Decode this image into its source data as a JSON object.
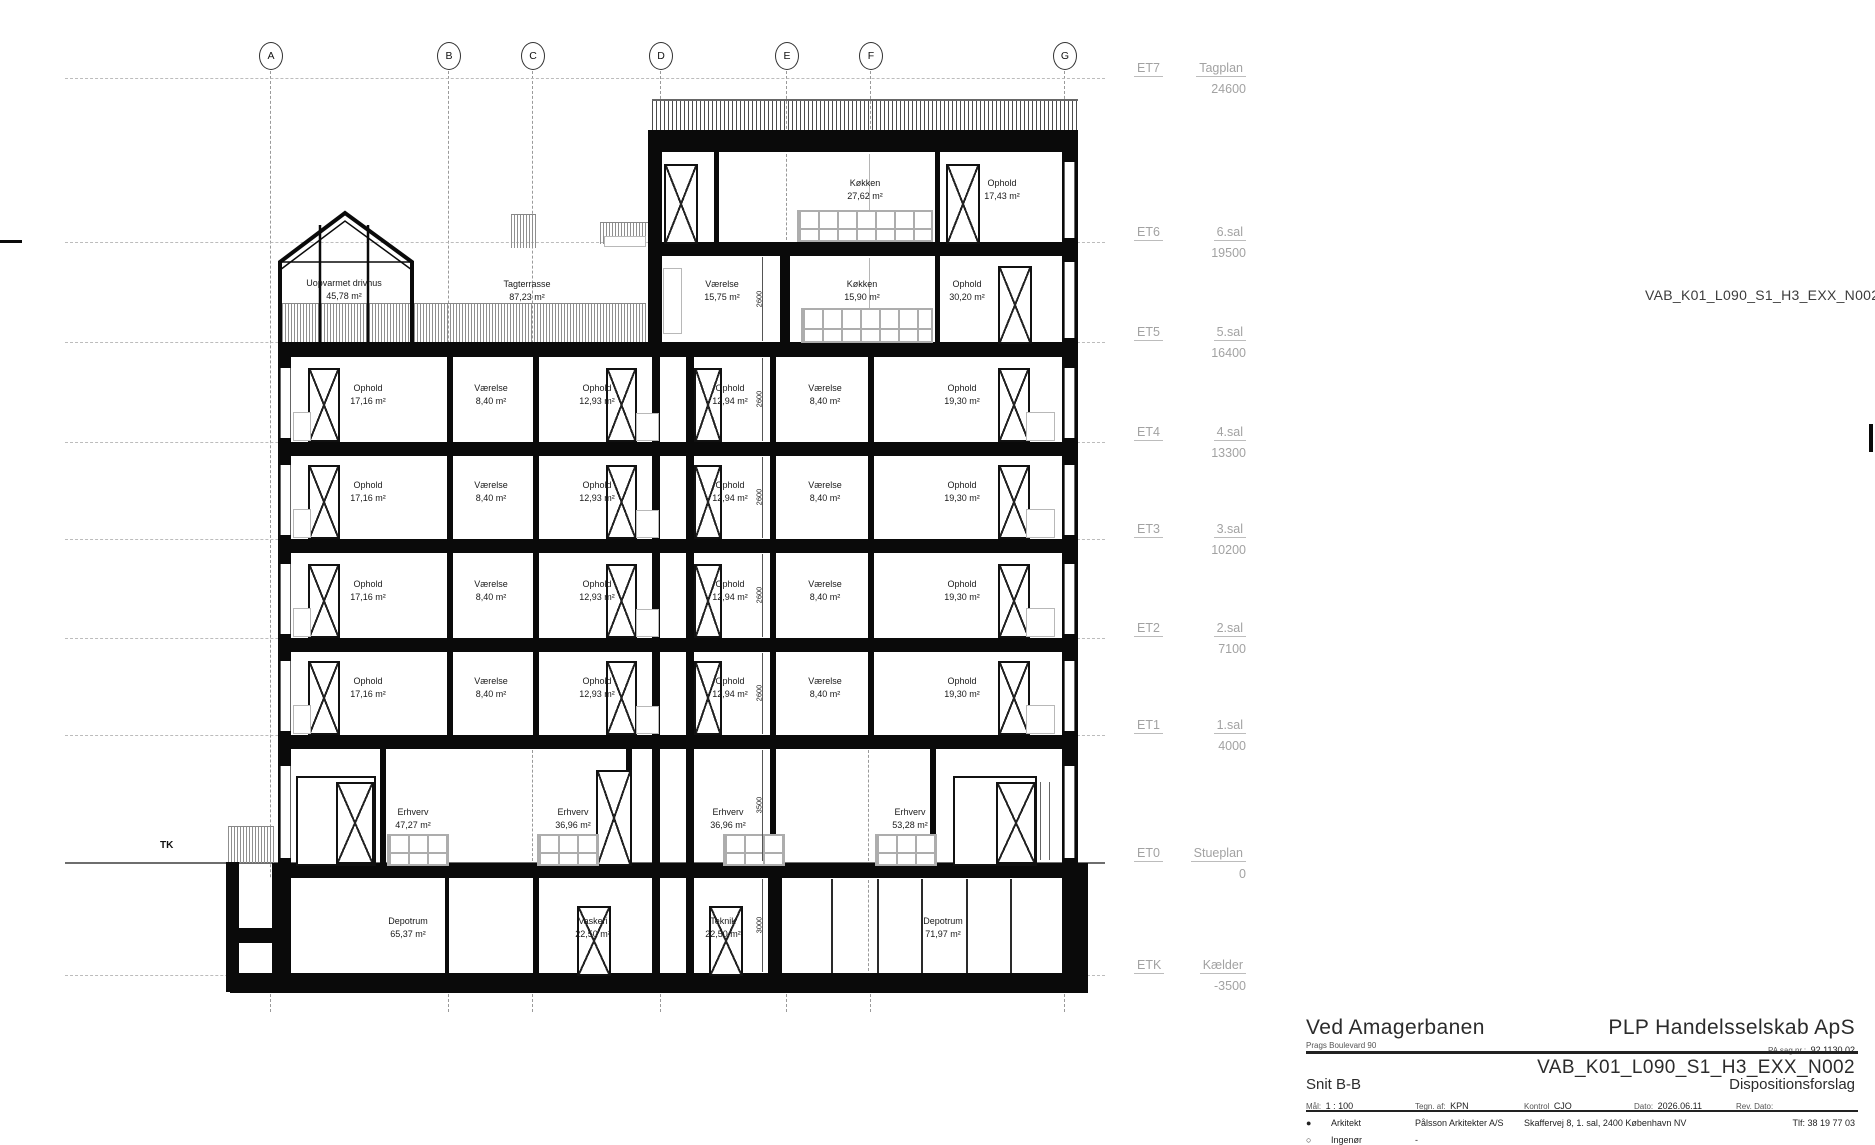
{
  "annotations": {
    "drawing_number": "VAB_K01_L090_S1_H3_EXX_N002",
    "tk": "TK"
  },
  "grid": {
    "labels": [
      "A",
      "B",
      "C",
      "D",
      "E",
      "F",
      "G"
    ]
  },
  "levels": [
    {
      "code": "ET7",
      "name": "Tagplan",
      "elevation": "24600"
    },
    {
      "code": "ET6",
      "name": "6.sal",
      "elevation": "19500"
    },
    {
      "code": "ET5",
      "name": "5.sal",
      "elevation": "16400"
    },
    {
      "code": "ET4",
      "name": "4.sal",
      "elevation": "13300"
    },
    {
      "code": "ET3",
      "name": "3.sal",
      "elevation": "10200"
    },
    {
      "code": "ET2",
      "name": "2.sal",
      "elevation": "7100"
    },
    {
      "code": "ET1",
      "name": "1.sal",
      "elevation": "4000"
    },
    {
      "code": "ET0",
      "name": "Stueplan",
      "elevation": "0"
    },
    {
      "code": "ETK",
      "name": "Kælder",
      "elevation": "-3500"
    }
  ],
  "dimensions": {
    "room_height": "2600",
    "ground_floor_height": "3500",
    "basement_height": "3000"
  },
  "rooms": {
    "floor6": [
      {
        "name": "Køkken",
        "area": "27,62 m²"
      },
      {
        "name": "Ophold",
        "area": "17,43 m²"
      }
    ],
    "floor5": [
      {
        "name": "Uopvarmet drivhus",
        "area": "45,78 m²"
      },
      {
        "name": "Tagterrasse",
        "area": "87,23 m²"
      },
      {
        "name": "Værelse",
        "area": "15,75 m²"
      },
      {
        "name": "Køkken",
        "area": "15,90 m²"
      },
      {
        "name": "Ophold",
        "area": "30,20 m²"
      }
    ],
    "typical": [
      {
        "name": "Ophold",
        "area": "17,16 m²"
      },
      {
        "name": "Værelse",
        "area": "8,40 m²"
      },
      {
        "name": "Ophold",
        "area": "12,93 m²"
      },
      {
        "name": "Ophold",
        "area": "12,94 m²"
      },
      {
        "name": "Værelse",
        "area": "8,40 m²"
      },
      {
        "name": "Ophold",
        "area": "19,30 m²"
      }
    ],
    "ground": [
      {
        "name": "Erhverv",
        "area": "47,27 m²"
      },
      {
        "name": "Erhverv",
        "area": "36,96 m²"
      },
      {
        "name": "Erhverv",
        "area": "36,96 m²"
      },
      {
        "name": "Erhverv",
        "area": "53,28 m²"
      }
    ],
    "basement": [
      {
        "name": "Depotrum",
        "area": "65,37 m²"
      },
      {
        "name": "Vaskeri",
        "area": "22,50 m²"
      },
      {
        "name": "Teknik",
        "area": "22,50 m²"
      },
      {
        "name": "Depotrum",
        "area": "71,97 m²"
      }
    ]
  },
  "title_block": {
    "project_name": "Ved Amagerbanen",
    "project_address": "Prags Boulevard 90",
    "client": "PLP Handelsselskab ApS",
    "case_label": "PA sag nr.:",
    "case_number": "92.1130.02",
    "drawing_number": "VAB_K01_L090_S1_H3_EXX_N002",
    "drawing_title": "Snit B-B",
    "phase": "Dispositionsforslag",
    "scale_label": "Mål:",
    "scale": "1 : 100",
    "drawn_label": "Tegn. af:",
    "drawn_by": "KPN",
    "control_label": "Kontrol",
    "controlled_by": "CJO",
    "date_label": "Dato:",
    "date": "2026.06.11",
    "rev_label": "Rev. Dato:",
    "bullet_filled": "●",
    "bullet_open": "○",
    "architect_label": "Arkitekt",
    "architect": "Pålsson Arkitekter A/S",
    "architect_address": "Skaffervej 8, 1. sal, 2400 København NV",
    "architect_phone": "Tlf: 38 19 77 03",
    "engineer_label": "Ingenør",
    "engineer": "-"
  }
}
